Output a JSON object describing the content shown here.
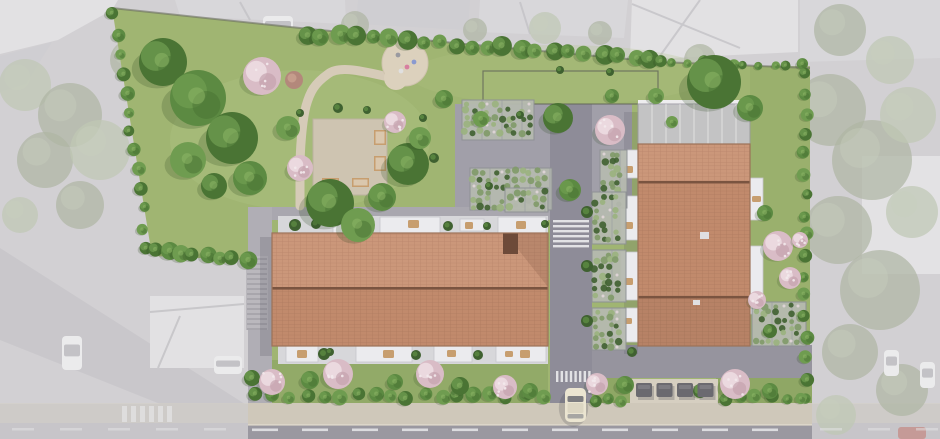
{
  "scene_type": "aerial-site-plan-rendering",
  "palette": {
    "surround": {
      "base": "#d2d0d3",
      "road": "#c7c5c9",
      "road_diag": "#c9c7cb",
      "roof_light": "#e2e1e3",
      "roof_mid": "#d8d7da",
      "roof_deep": "#cfced2",
      "green": "#aeb5a3",
      "green_light": "#bfc7b4",
      "white_bldg": "#e4e3e6",
      "car": "#ebebec",
      "car_red": "#c59a97",
      "stripe": "#e6e6e8"
    },
    "site": {
      "lawn": "#a0b572",
      "lawn_dark": "#8fa765",
      "lawn_light": "#aec283",
      "path": "#d6cbb8",
      "sand": "#dcd1bd",
      "terrace_beige": "#cec4b1",
      "walkway": "#a9a7af",
      "stairs": "#bab8bd",
      "stair_line": "#95939a",
      "road": "#8e8c98",
      "plaza": "#96949e",
      "court": "#a19fa9",
      "sidewalk": "#cfc8ba",
      "curb": "#dcd6c9",
      "boundary": "#6b6e60",
      "bin_platform": "#d6cfc1"
    },
    "building": {
      "tile_light": "#cb977a",
      "tile_light_line": "#b8846a",
      "tile_mid": "#c18a6c",
      "tile_mid_line": "#ad7a5e",
      "ridge": "#7a5440",
      "edge": "#9c7258",
      "inset_dark": "#6d4a39",
      "glazed": "#c6c5cb",
      "glazed_frame": "#9b9aa1",
      "terrace_white": "#ebebee",
      "terrace_base": "#d7d7da",
      "furniture_tan": "#c79e6f",
      "furniture_light": "#e2d8c8",
      "rooftop_unit": "#dfdfe2"
    },
    "green": {
      "tree_dark": "#4a7434",
      "tree_mid": "#5c8a42",
      "tree_light": "#6f9c50",
      "tree_sheen": "#8fb768",
      "hedge": "#3f6130",
      "vine": "#7f9a68",
      "vine_light": "#9ab37e",
      "blossom": "#d9bcc6",
      "blossom_light": "#ecdce1",
      "brown_tree": "#b3887b",
      "shadow": "#2e4a22"
    },
    "objects": {
      "bin": "#6b6a70",
      "bin_top": "#7d7c82",
      "car_body": "#ebe5d1",
      "car_glass": "#6a6b72",
      "car_rear": "#8a8b90",
      "crosswalk_stripe": "#e9e9eb",
      "lane_dash": "#e3e3e5"
    }
  },
  "scene": {
    "site_polygon": [
      [
        112,
        8
      ],
      [
        300,
        28
      ],
      [
        465,
        44
      ],
      [
        660,
        62
      ],
      [
        810,
        68
      ],
      [
        810,
        403
      ],
      [
        248,
        403
      ],
      [
        248,
        260
      ],
      [
        152,
        256
      ]
    ],
    "fence_rect": [
      483,
      71,
      175,
      33
    ],
    "playground": {
      "circle1": [
        405,
        63,
        23
      ],
      "circle2": [
        396,
        78,
        12
      ],
      "toys": [
        [
          398,
          55,
          "#9a9aa0"
        ],
        [
          407,
          67,
          "#d77fa0"
        ],
        [
          414,
          62,
          "#8a9ad0"
        ],
        [
          401,
          71,
          "#e0e0e0"
        ]
      ]
    },
    "park_path": "M384,76 C358,70 338,66 328,74 C314,84 310,92 306,106 C302,122 300,150 300,170 L300,206",
    "terrace_square": {
      "rect": [
        313,
        119,
        74,
        76
      ],
      "benches": [
        [
          374,
          130,
          12,
          15
        ],
        [
          374,
          156,
          12,
          15
        ],
        [
          322,
          178,
          17,
          9
        ],
        [
          352,
          178,
          17,
          9
        ]
      ]
    },
    "court_rect": [
      455,
      104,
      177,
      112
    ],
    "road_rect": [
      550,
      104,
      42,
      302
    ],
    "plaza_rect": [
      592,
      345,
      220,
      33
    ],
    "walkway_rect": [
      248,
      207,
      302,
      13
    ],
    "left_path_col": [
      248,
      207,
      24,
      196
    ],
    "stairs": {
      "rect": [
        246,
        256,
        22,
        74
      ],
      "step_gap": 5
    },
    "sidewalk_rect": [
      248,
      403,
      564,
      22
    ],
    "road_bottom_rect": [
      248,
      425,
      564,
      14
    ],
    "left_building": {
      "roof": [
        272,
        233,
        276,
        113
      ],
      "ridge_y": 287,
      "inset": [
        503,
        233,
        15,
        21
      ],
      "terrace_top_y": 216,
      "terrace_bottom_y": 346,
      "top_boxes": [
        [
          333,
          217,
          30,
          16
        ],
        [
          380,
          217,
          60,
          16
        ],
        [
          460,
          219,
          24,
          12
        ],
        [
          498,
          217,
          48,
          16
        ]
      ],
      "top_tables": [
        [
          346,
          221,
          10,
          8
        ],
        [
          408,
          220,
          11,
          8
        ],
        [
          465,
          222,
          8,
          7
        ],
        [
          516,
          221,
          10,
          8
        ]
      ],
      "top_bushes": [
        [
          295,
          225,
          6
        ],
        [
          316,
          224,
          5
        ],
        [
          356,
          226,
          5
        ],
        [
          448,
          226,
          5
        ],
        [
          487,
          226,
          4
        ],
        [
          545,
          224,
          4
        ]
      ],
      "bottom_boxes": [
        [
          286,
          346,
          32,
          16
        ],
        [
          356,
          346,
          56,
          16
        ],
        [
          434,
          346,
          38,
          16
        ],
        [
          496,
          346,
          50,
          16
        ]
      ],
      "bottom_tables": [
        [
          297,
          350,
          10,
          8
        ],
        [
          383,
          350,
          11,
          8
        ],
        [
          447,
          350,
          9,
          7
        ],
        [
          505,
          351,
          8,
          6
        ],
        [
          520,
          350,
          10,
          8
        ]
      ],
      "bottom_bushes": [
        [
          324,
          354,
          6
        ],
        [
          416,
          355,
          5
        ],
        [
          478,
          355,
          5
        ],
        [
          330,
          352,
          4
        ]
      ]
    },
    "right_building": {
      "glazed": [
        638,
        104,
        112,
        40
      ],
      "roof": [
        638,
        144,
        112,
        202
      ],
      "ridge_ys": [
        181,
        296
      ],
      "left_boxes": [
        [
          621,
          150,
          17,
          28
        ],
        [
          621,
          196,
          17,
          44
        ],
        [
          621,
          252,
          17,
          48
        ],
        [
          621,
          308,
          17,
          34
        ]
      ],
      "left_tables": [
        [
          624,
          166,
          9,
          7
        ],
        [
          624,
          222,
          9,
          7
        ],
        [
          624,
          278,
          9,
          7
        ],
        [
          624,
          318,
          8,
          6
        ]
      ],
      "right_boxes": [
        [
          750,
          178,
          13,
          42
        ],
        [
          750,
          246,
          13,
          68
        ]
      ],
      "right_tables": [
        [
          752,
          196,
          9,
          6
        ],
        [
          752,
          300,
          9,
          6
        ],
        [
          752,
          318,
          9,
          6
        ]
      ],
      "rooftop_units": [
        [
          700,
          232,
          9,
          7
        ],
        [
          693,
          300,
          7,
          5
        ]
      ]
    },
    "vine_blocks": [
      [
        462,
        100,
        72,
        40
      ],
      [
        470,
        168,
        82,
        42
      ],
      [
        505,
        188,
        43,
        24
      ],
      [
        600,
        150,
        27,
        58
      ],
      [
        592,
        192,
        34,
        52
      ],
      [
        592,
        250,
        34,
        52
      ],
      [
        592,
        308,
        34,
        42
      ],
      [
        752,
        302,
        54,
        44
      ]
    ],
    "trees": [
      [
        163,
        62,
        24,
        0
      ],
      [
        198,
        98,
        28,
        1
      ],
      [
        232,
        138,
        26,
        0
      ],
      [
        188,
        160,
        18,
        2
      ],
      [
        250,
        178,
        17,
        1
      ],
      [
        214,
        186,
        13,
        0
      ],
      [
        288,
        128,
        12,
        2
      ],
      [
        330,
        203,
        24,
        0
      ],
      [
        358,
        225,
        17,
        2
      ],
      [
        408,
        164,
        21,
        0
      ],
      [
        382,
        197,
        14,
        1
      ],
      [
        420,
        138,
        11,
        2
      ],
      [
        444,
        99,
        9,
        1
      ],
      [
        481,
        119,
        8,
        2
      ],
      [
        558,
        118,
        15,
        0
      ],
      [
        570,
        190,
        11,
        1
      ],
      [
        612,
        96,
        7,
        1
      ],
      [
        656,
        96,
        8,
        2
      ],
      [
        714,
        82,
        27,
        0
      ],
      [
        750,
        108,
        13,
        1
      ],
      [
        765,
        213,
        8,
        1
      ],
      [
        770,
        331,
        7,
        0
      ],
      [
        625,
        385,
        9,
        1
      ],
      [
        700,
        391,
        7,
        0
      ],
      [
        770,
        391,
        8,
        1
      ],
      [
        310,
        380,
        9,
        1
      ],
      [
        395,
        382,
        8,
        1
      ],
      [
        460,
        386,
        9,
        0
      ],
      [
        530,
        391,
        8,
        1
      ],
      [
        252,
        378,
        8,
        0
      ],
      [
        672,
        122,
        6,
        2
      ]
    ],
    "tree_rows": [
      {
        "x1": 306,
        "y1": 34,
        "x2": 652,
        "y2": 59,
        "n": 22,
        "rmin": 6,
        "rmax": 10
      },
      {
        "x1": 660,
        "y1": 62,
        "x2": 802,
        "y2": 66,
        "n": 11,
        "rmin": 4,
        "rmax": 7
      },
      {
        "x1": 114,
        "y1": 14,
        "x2": 148,
        "y2": 248,
        "n": 13,
        "rmin": 5,
        "rmax": 8
      },
      {
        "x1": 154,
        "y1": 252,
        "x2": 246,
        "y2": 258,
        "n": 8,
        "rmin": 6,
        "rmax": 9
      },
      {
        "x1": 256,
        "y1": 396,
        "x2": 542,
        "y2": 396,
        "n": 18,
        "rmin": 6,
        "rmax": 8
      },
      {
        "x1": 806,
        "y1": 72,
        "x2": 806,
        "y2": 398,
        "n": 17,
        "rmin": 5,
        "rmax": 7
      },
      {
        "x1": 596,
        "y1": 399,
        "x2": 622,
        "y2": 399,
        "n": 3,
        "rmin": 5,
        "rmax": 6
      },
      {
        "x1": 726,
        "y1": 398,
        "x2": 800,
        "y2": 398,
        "n": 6,
        "rmin": 5,
        "rmax": 7
      }
    ],
    "bushes": [
      [
        338,
        108,
        5
      ],
      [
        367,
        110,
        4
      ],
      [
        300,
        113,
        4
      ],
      [
        423,
        118,
        4
      ],
      [
        434,
        158,
        5
      ],
      [
        489,
        186,
        4
      ],
      [
        560,
        70,
        4
      ],
      [
        610,
        72,
        4
      ],
      [
        520,
        115,
        4
      ],
      [
        587,
        212,
        6
      ],
      [
        587,
        266,
        6
      ],
      [
        587,
        321,
        6
      ],
      [
        632,
        352,
        5
      ]
    ],
    "blossoms": [
      [
        262,
        76,
        19
      ],
      [
        300,
        168,
        13
      ],
      [
        610,
        130,
        15
      ],
      [
        395,
        122,
        11
      ],
      [
        272,
        382,
        13
      ],
      [
        338,
        374,
        15
      ],
      [
        430,
        374,
        14
      ],
      [
        505,
        387,
        12
      ],
      [
        597,
        384,
        11
      ],
      [
        735,
        384,
        15
      ],
      [
        778,
        246,
        15
      ],
      [
        790,
        278,
        11
      ],
      [
        757,
        300,
        9
      ],
      [
        800,
        240,
        8
      ]
    ],
    "brown_tree": [
      294,
      80,
      9
    ],
    "bins": {
      "count": 4,
      "x": 636,
      "y": 383,
      "w": 16,
      "h": 14,
      "gap": 20.5,
      "platform": [
        630,
        379,
        88,
        24
      ]
    },
    "car": {
      "x": 565,
      "y": 388,
      "w": 21,
      "h": 34
    },
    "crosswalk_top": {
      "x": 553,
      "y": 220,
      "w": 36,
      "stripes": 6,
      "sh": 2.4,
      "gap": 2.6
    },
    "crosswalk_bottom": {
      "y": 371,
      "h": 11,
      "x0": 556,
      "stripes": 8,
      "sw": 2.4,
      "gap": 2.2
    },
    "green_strips_south": [
      [
        592,
        378,
        40,
        25
      ],
      [
        716,
        378,
        96,
        25
      ]
    ],
    "surround": {
      "roof_polys": [
        {
          "pts": "0,0 118,0 112,10 58,40 0,54",
          "fill": "roof_light"
        },
        {
          "pts": "0,56 52,42 26,84 0,92",
          "fill": "roof_deep"
        },
        {
          "pts": "175,0 345,0 346,24 180,16",
          "fill": "roof_mid"
        },
        {
          "pts": "358,0 470,0 468,30 356,24",
          "fill": "roof_deep"
        },
        {
          "pts": "480,0 628,0 624,38 478,32",
          "fill": "roof_mid"
        },
        {
          "pts": "632,0 798,0 798,52 630,60",
          "fill": "roof_light"
        },
        {
          "pts": "800,0 940,0 940,58 800,62",
          "fill": "roof_mid"
        }
      ],
      "diag_road": "0,248 248,406 248,439 0,340",
      "house_bl": [
        150,
        296,
        94,
        72
      ],
      "white_bldg_r": [
        862,
        156,
        78,
        118
      ],
      "muted_trees": [
        [
          25,
          85,
          26
        ],
        [
          70,
          115,
          32
        ],
        [
          45,
          160,
          28
        ],
        [
          100,
          150,
          30
        ],
        [
          80,
          205,
          24
        ],
        [
          130,
          60,
          20
        ],
        [
          20,
          215,
          18
        ],
        [
          355,
          25,
          14
        ],
        [
          475,
          30,
          12
        ],
        [
          545,
          28,
          16
        ],
        [
          600,
          33,
          12
        ],
        [
          840,
          30,
          26
        ],
        [
          890,
          60,
          24
        ],
        [
          830,
          110,
          36
        ],
        [
          872,
          160,
          40
        ],
        [
          908,
          115,
          28
        ],
        [
          838,
          230,
          34
        ],
        [
          880,
          290,
          40
        ],
        [
          912,
          212,
          26
        ],
        [
          850,
          352,
          28
        ],
        [
          902,
          390,
          26
        ],
        [
          836,
          415,
          20
        ],
        [
          652,
          80,
          18
        ],
        [
          700,
          60,
          16
        ],
        [
          640,
          120,
          14
        ]
      ],
      "cars": [
        [
          263,
          16,
          30,
          20
        ],
        [
          62,
          336,
          20,
          34
        ],
        [
          214,
          356,
          28,
          18
        ],
        [
          884,
          350,
          15,
          26
        ],
        [
          920,
          362,
          15,
          26
        ]
      ],
      "red_car": [
        898,
        427,
        28,
        12
      ],
      "crosswalk_bl": {
        "x0": 122,
        "y": 406,
        "h": 16,
        "stripes": 6,
        "sw": 5,
        "gap": 4
      }
    }
  }
}
